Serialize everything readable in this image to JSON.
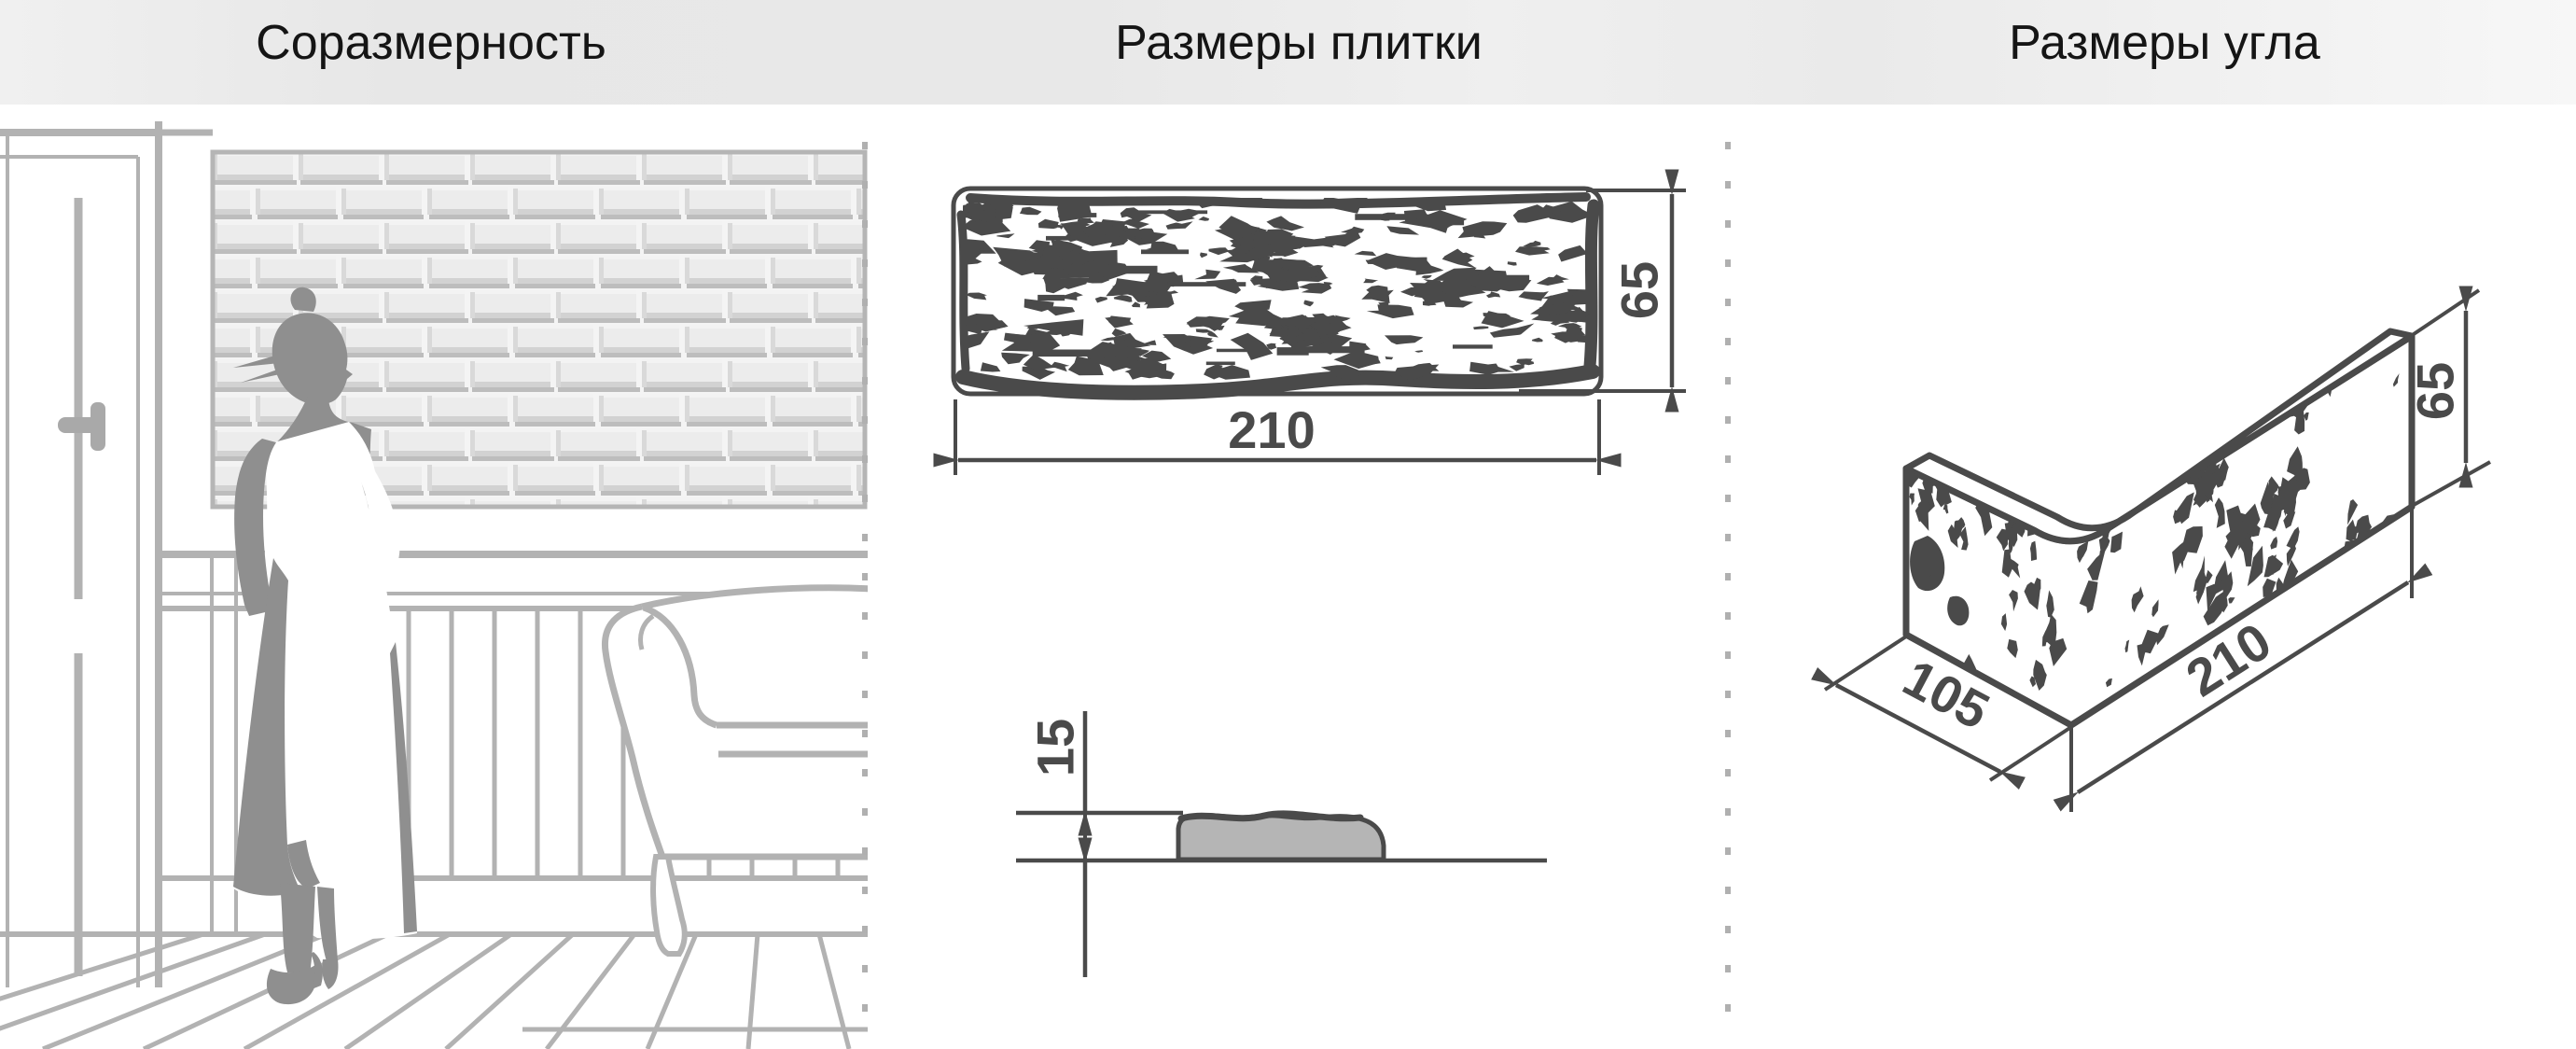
{
  "header": {
    "titles": [
      {
        "id": "proportion",
        "label": "Соразмерность"
      },
      {
        "id": "tile-sizes",
        "label": "Размеры плитки"
      },
      {
        "id": "corner-sizes",
        "label": "Размеры угла"
      }
    ]
  },
  "tile_front_view": {
    "width_mm": "210",
    "height_mm": "65"
  },
  "tile_side_view": {
    "thickness_mm": "15"
  },
  "corner_view": {
    "depth_mm": "105",
    "length_mm": "210",
    "height_mm": "65"
  },
  "colors": {
    "dimension_ink": "#4a4a4a",
    "scene_line": "#b2b2b2",
    "silhouette": "#8f8f8f",
    "profile_fill": "#b5b5b5",
    "separator": "#b0b0b0",
    "header_background": "#e8e8e8",
    "header_text": "#151515"
  }
}
